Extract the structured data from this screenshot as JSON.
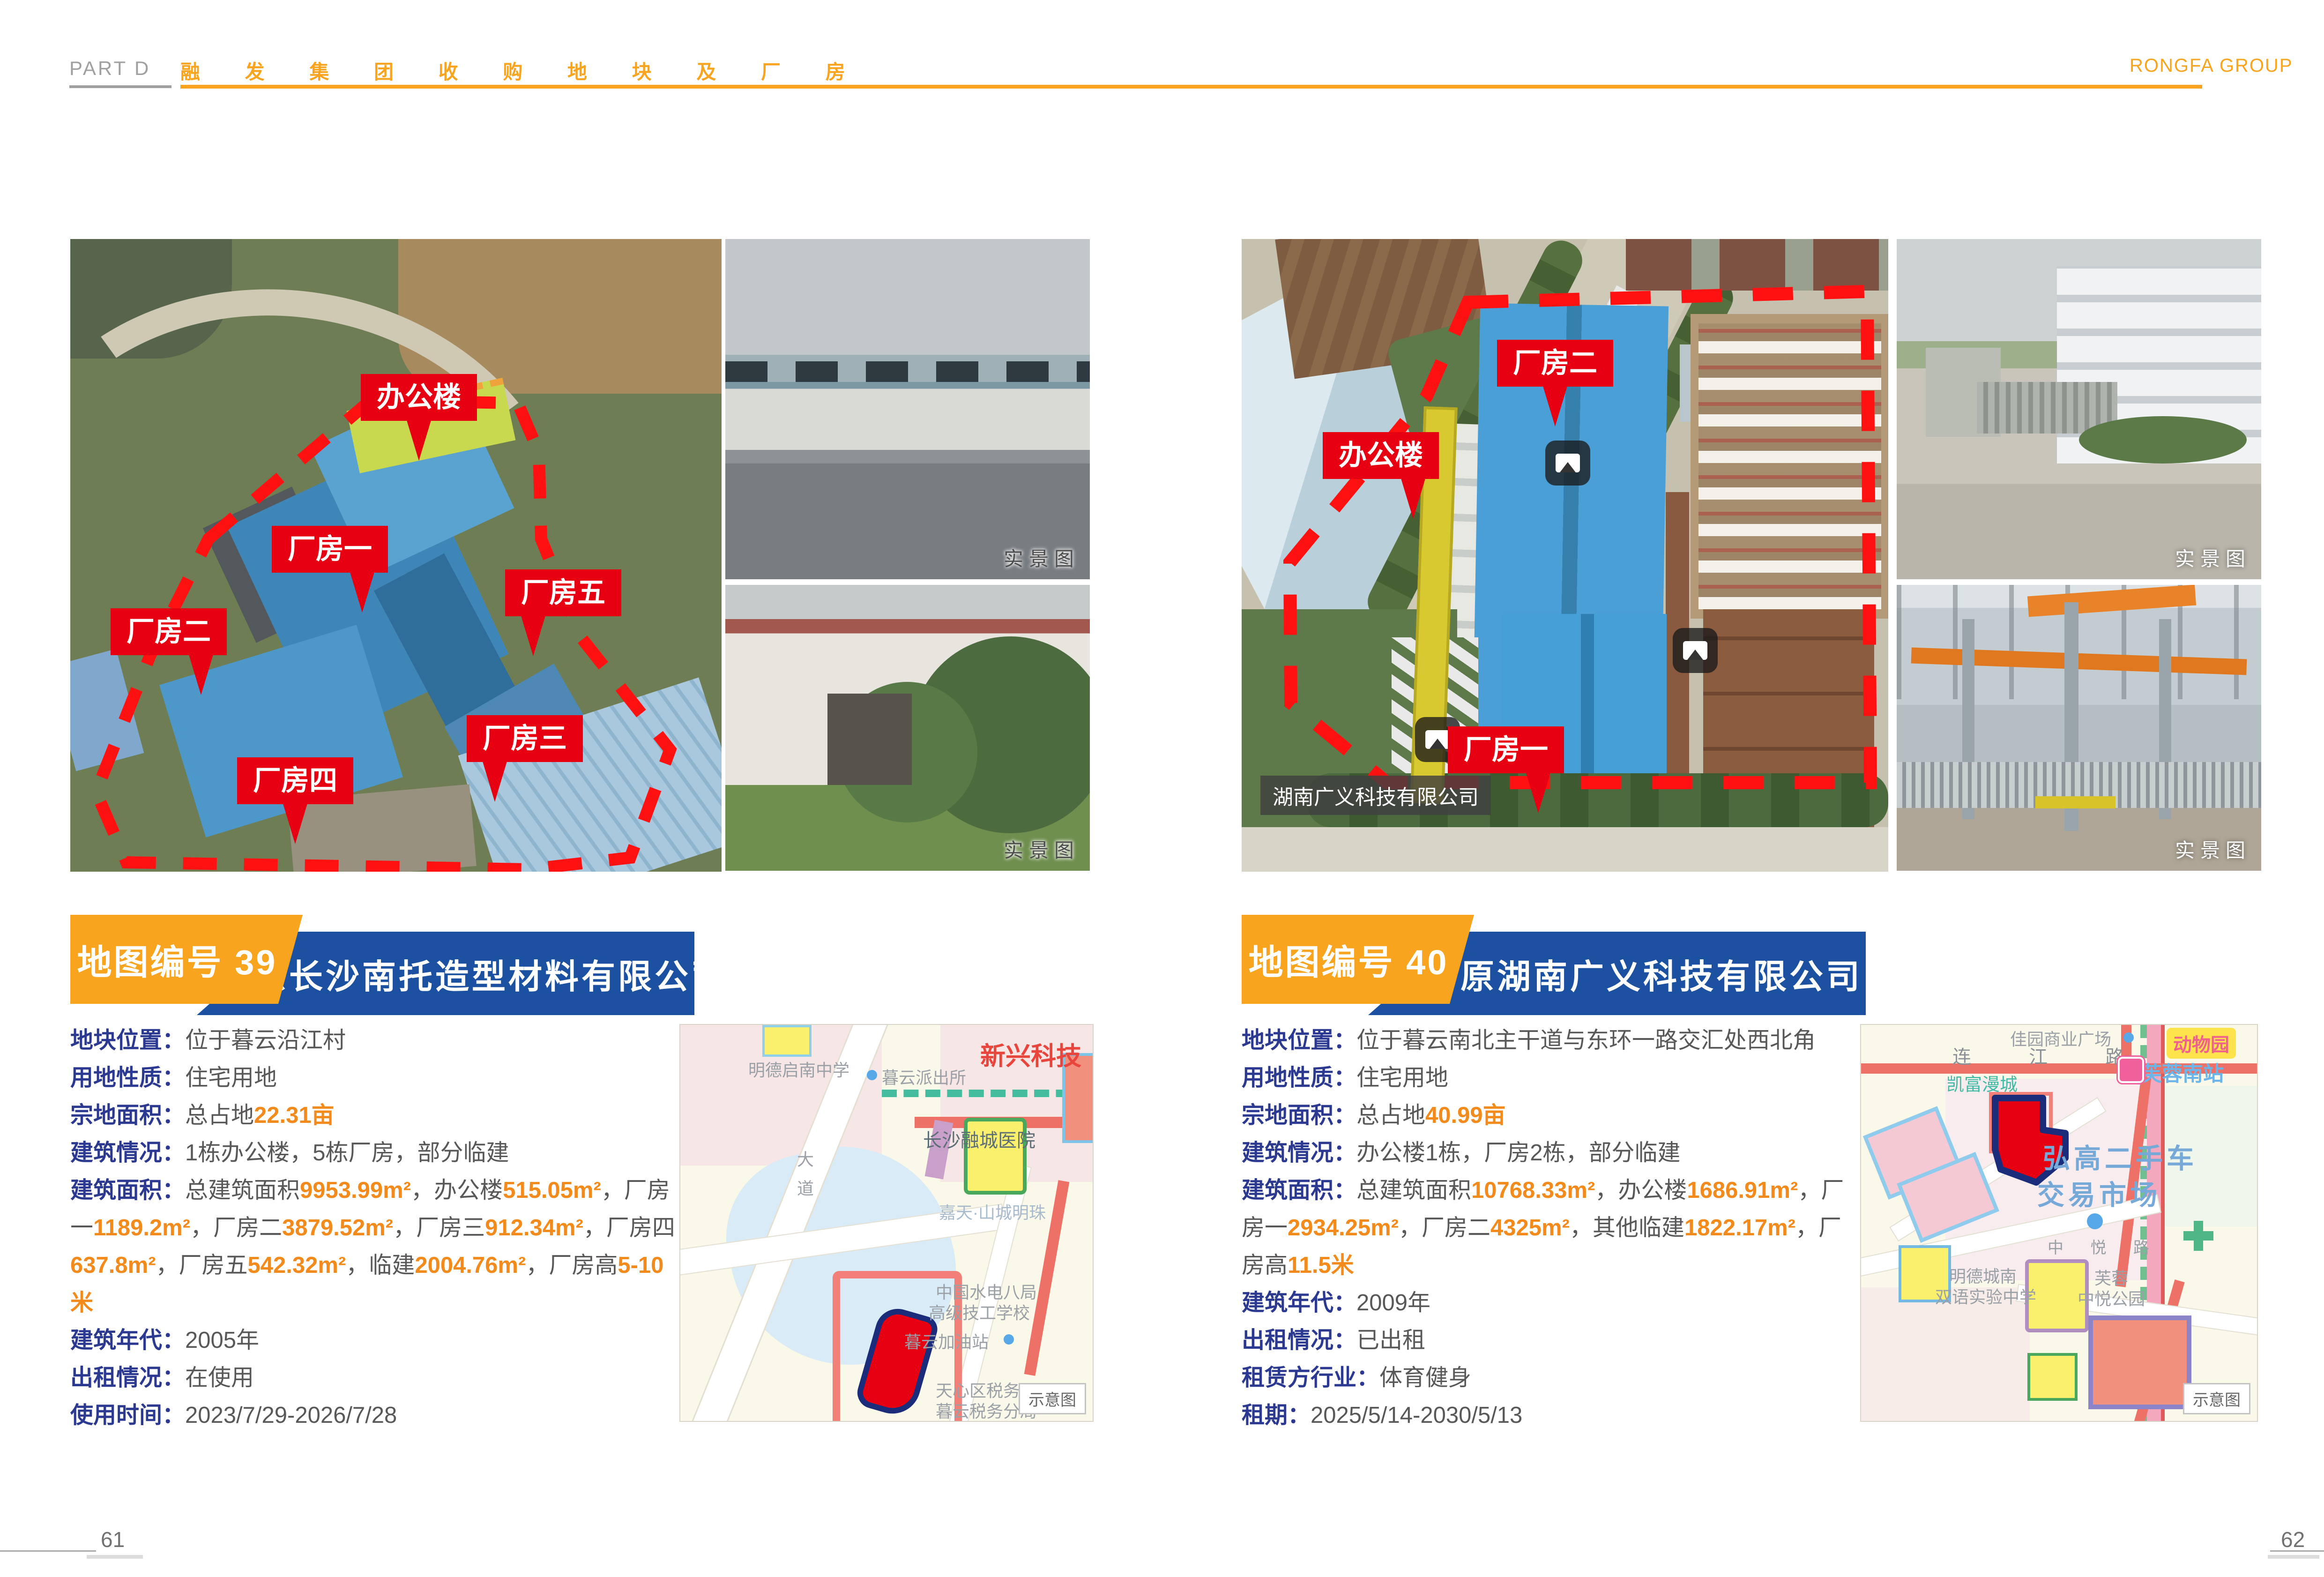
{
  "header": {
    "part": "PART D",
    "title": "融 发 集 团 收 购 地 块 及 厂 房",
    "brand": "RONGFA GROUP"
  },
  "footer": {
    "left_page": "61",
    "right_page": "62"
  },
  "badges": {
    "photo": "实景图",
    "map": "示意图"
  },
  "colors": {
    "accent_orange": "#F8A41E",
    "banner_blue": "#1B51A0",
    "label_navy": "#2B3990",
    "value_gray": "#595757",
    "number_orange": "#F28A1C",
    "callout_red": "#E60012"
  },
  "s39": {
    "map_no": "地图编号 39",
    "company": "原长沙南托造型材料有限公司",
    "aerial_labels": [
      "办公楼",
      "厂房一",
      "厂房五",
      "厂房二",
      "厂房三",
      "厂房四"
    ],
    "details": [
      {
        "label": "地块位置：",
        "segments": [
          [
            "位于暮云沿江村",
            "g"
          ]
        ]
      },
      {
        "label": "用地性质：",
        "segments": [
          [
            "住宅用地",
            "g"
          ]
        ]
      },
      {
        "label": "宗地面积：",
        "segments": [
          [
            "总占地",
            "g"
          ],
          [
            "22.31亩",
            "o"
          ]
        ]
      },
      {
        "label": "建筑情况：",
        "segments": [
          [
            "1栋办公楼，5栋厂房，部分临建",
            "g"
          ]
        ]
      },
      {
        "label": "建筑面积：",
        "segments": [
          [
            "总建筑面积",
            "g"
          ],
          [
            "9953.99m²",
            "o"
          ],
          [
            "，办公楼",
            "g"
          ],
          [
            "515.05m²",
            "o"
          ],
          [
            "，厂房一",
            "g"
          ],
          [
            "1189.2m²",
            "o"
          ],
          [
            "，厂房二",
            "g"
          ],
          [
            "3879.52m²",
            "o"
          ],
          [
            "，厂房三",
            "g"
          ],
          [
            "912.34m²",
            "o"
          ],
          [
            "，厂房四",
            "g"
          ],
          [
            "637.8m²",
            "o"
          ],
          [
            "，厂房五",
            "g"
          ],
          [
            "542.32m²",
            "o"
          ],
          [
            "，临建",
            "g"
          ],
          [
            "2004.76m²",
            "o"
          ],
          [
            "，厂房高",
            "g"
          ],
          [
            "5-10米",
            "o"
          ]
        ]
      },
      {
        "label": "建筑年代：",
        "segments": [
          [
            "2005年",
            "g"
          ]
        ]
      },
      {
        "label": "出租情况：",
        "segments": [
          [
            "在使用",
            "g"
          ]
        ]
      },
      {
        "label": "使用时间：",
        "segments": [
          [
            "2023/7/29-2026/7/28",
            "g"
          ]
        ]
      }
    ],
    "map_labels": {
      "school": "明德启南中学",
      "police": "暮云派出所",
      "tech": "新兴科技",
      "hospital": "长沙融城医院",
      "estate": "嘉天·山城明珠",
      "college1": "中国水电八局",
      "college2": "高级技工学校",
      "gas": "暮云加油站",
      "tax1": "天心区税务局",
      "tax2": "暮云税务分局",
      "road": "大道"
    }
  },
  "s40": {
    "map_no": "地图编号 40",
    "company": "原湖南广义科技有限公司",
    "aerial_labels": [
      "厂房二",
      "办公楼",
      "厂房一"
    ],
    "aerial_tag": "湖南广义科技有限公司",
    "details": [
      {
        "label": "地块位置：",
        "segments": [
          [
            "位于暮云南北主干道与东环一路交汇处西北角",
            "g"
          ]
        ]
      },
      {
        "label": "用地性质：",
        "segments": [
          [
            "住宅用地",
            "g"
          ]
        ]
      },
      {
        "label": "宗地面积：",
        "segments": [
          [
            "总占地",
            "g"
          ],
          [
            "40.99亩",
            "o"
          ]
        ]
      },
      {
        "label": "建筑情况：",
        "segments": [
          [
            "办公楼1栋，厂房2栋，部分临建",
            "g"
          ]
        ]
      },
      {
        "label": "建筑面积：",
        "segments": [
          [
            "总建筑面积",
            "g"
          ],
          [
            "10768.33m²",
            "o"
          ],
          [
            "，办公楼",
            "g"
          ],
          [
            "1686.91m²",
            "o"
          ],
          [
            "，厂房一",
            "g"
          ],
          [
            "2934.25m²",
            "o"
          ],
          [
            "，厂房二",
            "g"
          ],
          [
            "4325m²",
            "o"
          ],
          [
            "，其他临建",
            "g"
          ],
          [
            "1822.17m²",
            "o"
          ],
          [
            "，厂房高",
            "g"
          ],
          [
            "11.5米",
            "o"
          ]
        ]
      },
      {
        "label": "建筑年代：",
        "segments": [
          [
            "2009年",
            "g"
          ]
        ]
      },
      {
        "label": "出租情况：",
        "segments": [
          [
            "已出租",
            "g"
          ]
        ]
      },
      {
        "label": "租赁方行业：",
        "segments": [
          [
            "体育健身",
            "g"
          ]
        ]
      },
      {
        "label": "租期：",
        "segments": [
          [
            "2025/5/14-2030/5/13",
            "g"
          ]
        ]
      }
    ],
    "map_labels": {
      "plaza": "佳园商业广场",
      "road1": "连 江 路",
      "zoo": "动物园",
      "station": "芙蓉南站",
      "kaifu": "凯富漫城",
      "market1": "弘高二手车",
      "market2": "交易市场",
      "zhongyue": "中 悦 路",
      "school1": "明德城南",
      "school2": "双语实验中学",
      "park1": "芙蓉",
      "park2": "中悦公园"
    }
  }
}
